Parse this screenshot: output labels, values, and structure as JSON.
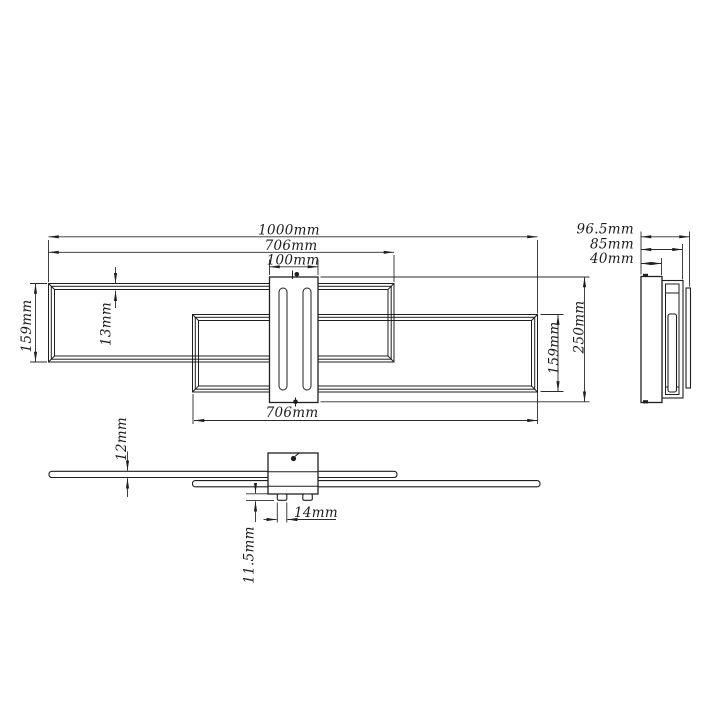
{
  "colors": {
    "background": "#ffffff",
    "line": "#1f1f1f"
  },
  "dims": {
    "total_length": "1000mm",
    "top_frame_length": "706mm",
    "canopy_width": "100mm",
    "left_frame_height": "159mm",
    "profile_width": "13mm",
    "right_frame_height": "159mm",
    "total_height": "250mm",
    "side_total_depth": "96.5mm",
    "side_frame_depth": "85mm",
    "side_canopy_depth": "40mm",
    "bottom_frame_length": "706mm",
    "profile_thickness": "12mm",
    "foot_height": "11.5mm",
    "foot_width": "14mm"
  }
}
